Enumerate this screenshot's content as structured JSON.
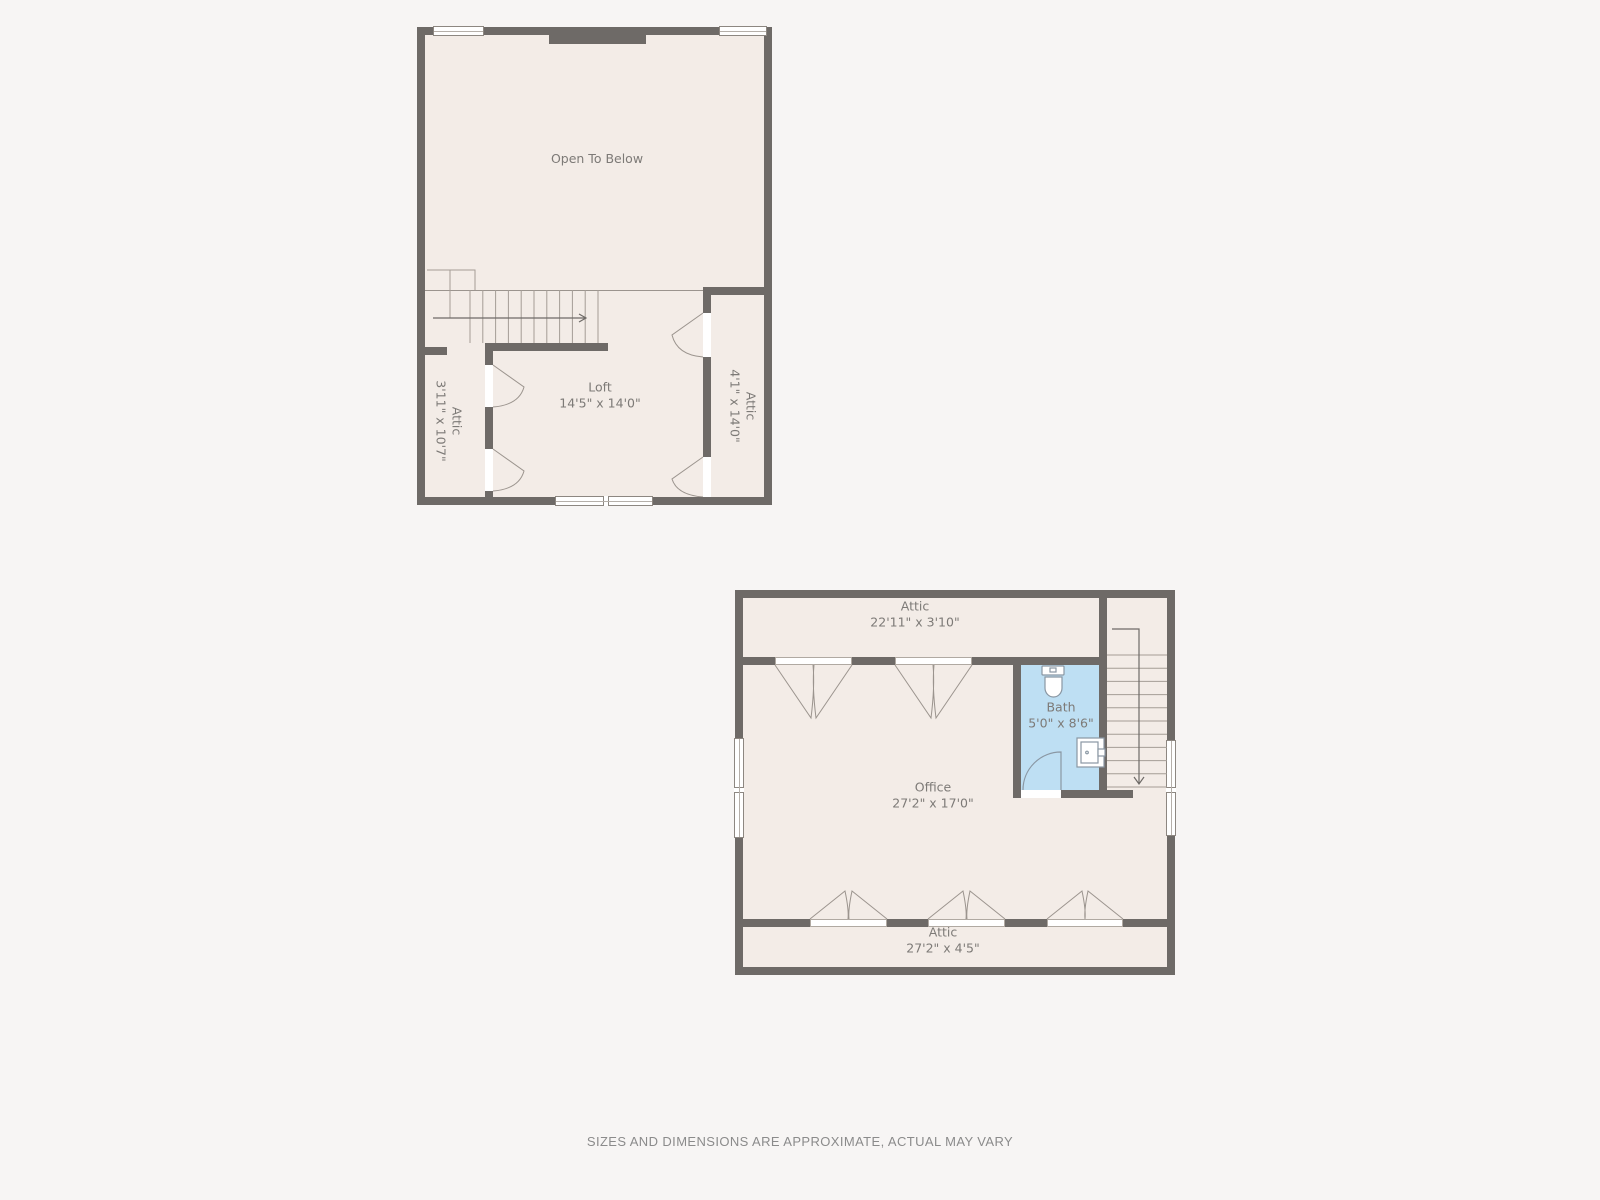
{
  "page": {
    "background": "#f7f5f4"
  },
  "colors": {
    "wall": "#6e6a67",
    "floor": "#f3ece7",
    "bath_fill": "#bedff3",
    "thin_line": "#9b948e",
    "label_text": "#7d7a77",
    "footer_text": "#8b8b8b",
    "window_fill": "#ffffff"
  },
  "upper_plan": {
    "open_to_below_label": "Open To Below",
    "rooms": {
      "loft": {
        "name": "Loft",
        "dims": "14'5\" x 14'0\""
      },
      "attic_left": {
        "name": "Attic",
        "dims": "3'11\" x 10'7\""
      },
      "attic_right": {
        "name": "Attic",
        "dims": "4'1\" x 14'0\""
      }
    }
  },
  "lower_plan": {
    "rooms": {
      "attic_top": {
        "name": "Attic",
        "dims": "22'11\" x 3'10\""
      },
      "bath": {
        "name": "Bath",
        "dims": "5'0\" x 8'6\""
      },
      "office": {
        "name": "Office",
        "dims": "27'2\" x 17'0\""
      },
      "attic_bottom": {
        "name": "Attic",
        "dims": "27'2\" x 4'5\""
      }
    }
  },
  "footer": {
    "disclaimer": "SIZES AND DIMENSIONS ARE APPROXIMATE, ACTUAL MAY VARY"
  }
}
